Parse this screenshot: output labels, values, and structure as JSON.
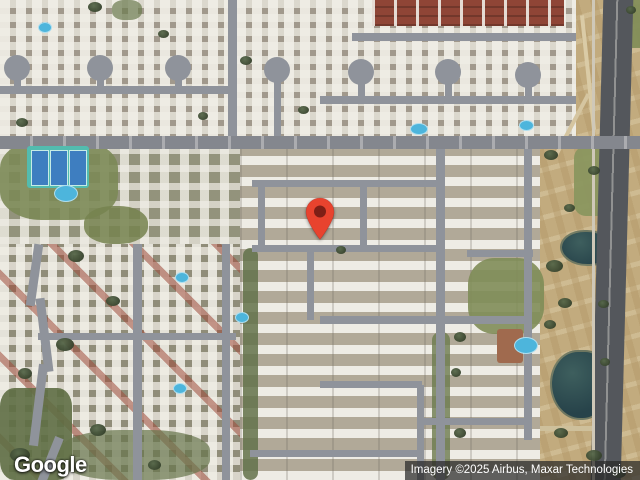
{
  "ui": {
    "logo_text": "Google",
    "attribution_text": "Imagery ©2025 Airbus, Maxar Technologies"
  },
  "map": {
    "type": "satellite",
    "marker": {
      "x": 320,
      "y": 241,
      "color": "#E8432E",
      "dot_color": "#7E1F16"
    },
    "palette": {
      "road": "#8F939B",
      "road_major": "#84878E",
      "highway": "#54575C",
      "desert": "#C2AB7E",
      "pond": "#27434A",
      "pool": "#4DB5DC",
      "tennis": "#53BCAF",
      "court": "#3E7EC0",
      "roof_white": "#F0EEE6",
      "roof_red": "#9E4B3B",
      "grass": "#7C8A57",
      "tree": "#36422C",
      "marker_red": "#E8432E"
    },
    "features": [
      {
        "n": "desert-strip",
        "x": 532,
        "y": 0,
        "w": 108,
        "h": 480,
        "cls": "pattern-desert"
      },
      {
        "n": "district-top-left",
        "x": 0,
        "y": 0,
        "w": 236,
        "h": 148,
        "cls": "pattern-houses"
      },
      {
        "n": "district-top-mid",
        "x": 236,
        "y": 0,
        "w": 340,
        "h": 148,
        "cls": "pattern-houses"
      },
      {
        "n": "district-mid-left",
        "x": 0,
        "y": 148,
        "w": 240,
        "h": 96,
        "cls": "pattern-houses-sparse"
      },
      {
        "n": "district-center-condos",
        "x": 240,
        "y": 148,
        "w": 300,
        "h": 332,
        "cls": "pattern-condos"
      },
      {
        "n": "district-bottom-left",
        "x": 0,
        "y": 244,
        "w": 240,
        "h": 236,
        "cls": "pattern-houses-red"
      },
      {
        "n": "red-roof-apartments",
        "x": 372,
        "y": 0,
        "w": 192,
        "h": 26,
        "cls": "pattern-red-roofs"
      },
      {
        "n": "green-park",
        "x": 0,
        "y": 140,
        "w": 118,
        "h": 80,
        "c": "#7C8A57",
        "r": "35%",
        "o": 0.9
      },
      {
        "n": "green-patch",
        "x": 84,
        "y": 206,
        "w": 64,
        "h": 38,
        "c": "#75834F",
        "r": "45%",
        "o": 0.85
      },
      {
        "n": "green-trees",
        "x": 0,
        "y": 388,
        "w": 72,
        "h": 92,
        "c": "#5E6E44",
        "r": "20%",
        "o": 0.9
      },
      {
        "n": "green-trees",
        "x": 60,
        "y": 430,
        "w": 150,
        "h": 50,
        "c": "#66754B",
        "r": "40%",
        "o": 0.7
      },
      {
        "n": "green-tree-strip",
        "x": 243,
        "y": 248,
        "w": 15,
        "h": 232,
        "c": "#63724A",
        "r": "8px",
        "o": 0.85
      },
      {
        "n": "green-lawn",
        "x": 468,
        "y": 258,
        "w": 76,
        "h": 76,
        "c": "#7F8D58",
        "r": "35%",
        "o": 0.9
      },
      {
        "n": "green-grass",
        "x": 574,
        "y": 146,
        "w": 44,
        "h": 70,
        "c": "#8A965F",
        "r": "12px",
        "o": 0.95
      },
      {
        "n": "green-corner",
        "x": 620,
        "y": 0,
        "w": 20,
        "h": 48,
        "c": "#7F8D58",
        "o": 0.9
      },
      {
        "n": "green-trees",
        "x": 112,
        "y": 0,
        "w": 30,
        "h": 20,
        "c": "#6B7A4E",
        "r": "40%",
        "o": 0.7
      },
      {
        "n": "green-strip",
        "x": 432,
        "y": 332,
        "w": 18,
        "h": 148,
        "c": "#6B7A4E",
        "r": "8px",
        "o": 0.8
      },
      {
        "n": "pond-small",
        "x": 560,
        "y": 230,
        "w": 48,
        "h": 32,
        "cls": "pond",
        "r": "50% 50% 45% 55%"
      },
      {
        "n": "pond-large",
        "x": 550,
        "y": 350,
        "w": 54,
        "h": 66,
        "cls": "pond",
        "r": "55% 45% 50% 60%"
      },
      {
        "n": "desert-path",
        "x": 586,
        "y": 15,
        "w": 4,
        "h": 115,
        "c": "#DACBA6",
        "rot": -6
      },
      {
        "n": "desert-path",
        "x": 570,
        "y": 90,
        "w": 4,
        "h": 70,
        "c": "#D5C5A0",
        "rot": 28
      },
      {
        "n": "desert-path",
        "x": 540,
        "y": 426,
        "w": 72,
        "h": 5,
        "c": "#CEC09B"
      },
      {
        "n": "highway",
        "x": 597,
        "y": -6,
        "w": 30,
        "h": 492,
        "cls": "highway",
        "rot": 1.5
      },
      {
        "n": "highway-shoulder",
        "x": 592,
        "y": 0,
        "w": 3,
        "h": 480,
        "c": "#CFC8B8"
      },
      {
        "n": "road",
        "x": 0,
        "y": 86,
        "w": 236,
        "h": 8,
        "cls": "road"
      },
      {
        "n": "road",
        "x": 352,
        "y": 33,
        "w": 224,
        "h": 8,
        "cls": "road"
      },
      {
        "n": "road",
        "x": 320,
        "y": 96,
        "w": 256,
        "h": 8,
        "cls": "road"
      },
      {
        "n": "road",
        "x": 252,
        "y": 180,
        "w": 192,
        "h": 7,
        "cls": "road"
      },
      {
        "n": "road",
        "x": 252,
        "y": 245,
        "w": 192,
        "h": 7,
        "cls": "road"
      },
      {
        "n": "road",
        "x": 467,
        "y": 250,
        "w": 66,
        "h": 7,
        "cls": "road"
      },
      {
        "n": "road",
        "x": 320,
        "y": 316,
        "w": 208,
        "h": 8,
        "cls": "road"
      },
      {
        "n": "road",
        "x": 38,
        "y": 333,
        "w": 198,
        "h": 7,
        "cls": "road"
      },
      {
        "n": "road",
        "x": 320,
        "y": 381,
        "w": 102,
        "h": 7,
        "cls": "road"
      },
      {
        "n": "road",
        "x": 417,
        "y": 418,
        "w": 110,
        "h": 7,
        "cls": "road"
      },
      {
        "n": "road",
        "x": 250,
        "y": 450,
        "w": 172,
        "h": 7,
        "cls": "road"
      },
      {
        "n": "road",
        "x": 228,
        "y": 0,
        "w": 9,
        "h": 144,
        "cls": "road"
      },
      {
        "n": "road",
        "x": 133,
        "y": 244,
        "w": 9,
        "h": 236,
        "cls": "road"
      },
      {
        "n": "road",
        "x": 222,
        "y": 244,
        "w": 8,
        "h": 236,
        "cls": "road"
      },
      {
        "n": "road",
        "x": 436,
        "y": 148,
        "w": 9,
        "h": 332,
        "cls": "road"
      },
      {
        "n": "road",
        "x": 524,
        "y": 148,
        "w": 8,
        "h": 292,
        "cls": "road"
      },
      {
        "n": "road",
        "x": 258,
        "y": 183,
        "w": 7,
        "h": 66,
        "cls": "road"
      },
      {
        "n": "road",
        "x": 360,
        "y": 183,
        "w": 7,
        "h": 66,
        "cls": "road"
      },
      {
        "n": "road",
        "x": 307,
        "y": 250,
        "w": 7,
        "h": 70,
        "cls": "road"
      },
      {
        "n": "road",
        "x": 417,
        "y": 385,
        "w": 7,
        "h": 95,
        "cls": "road"
      },
      {
        "n": "road-curve",
        "x": 30,
        "y": 244,
        "w": 9,
        "h": 62,
        "cls": "road",
        "rot": 8
      },
      {
        "n": "road-curve",
        "x": 40,
        "y": 298,
        "w": 9,
        "h": 74,
        "cls": "road",
        "rot": -7
      },
      {
        "n": "road-curve",
        "x": 34,
        "y": 364,
        "w": 9,
        "h": 82,
        "cls": "road",
        "rot": 7
      },
      {
        "n": "road-curve",
        "x": 46,
        "y": 436,
        "w": 9,
        "h": 48,
        "cls": "road",
        "rot": 22
      },
      {
        "n": "culdesac-stem",
        "x": 14,
        "y": 74,
        "w": 7,
        "h": 14,
        "cls": "road"
      },
      {
        "n": "culdesac-stem",
        "x": 97,
        "y": 74,
        "w": 7,
        "h": 14,
        "cls": "road"
      },
      {
        "n": "culdesac-stem",
        "x": 175,
        "y": 74,
        "w": 7,
        "h": 14,
        "cls": "road"
      },
      {
        "n": "culdesac-stem",
        "x": 274,
        "y": 80,
        "w": 7,
        "h": 58,
        "cls": "road"
      },
      {
        "n": "culdesac-stem",
        "x": 358,
        "y": 80,
        "w": 7,
        "h": 20,
        "cls": "road"
      },
      {
        "n": "culdesac-stem",
        "x": 445,
        "y": 80,
        "w": 7,
        "h": 20,
        "cls": "road"
      },
      {
        "n": "culdesac-stem",
        "x": 525,
        "y": 82,
        "w": 7,
        "h": 18,
        "cls": "road"
      },
      {
        "n": "culdesac",
        "x": 4,
        "y": 55,
        "w": 26,
        "h": 26,
        "cls": "road",
        "r": "50%"
      },
      {
        "n": "culdesac",
        "x": 87,
        "y": 55,
        "w": 26,
        "h": 26,
        "cls": "road",
        "r": "50%"
      },
      {
        "n": "culdesac",
        "x": 165,
        "y": 55,
        "w": 26,
        "h": 26,
        "cls": "road",
        "r": "50%"
      },
      {
        "n": "culdesac",
        "x": 264,
        "y": 57,
        "w": 26,
        "h": 26,
        "cls": "road",
        "r": "50%"
      },
      {
        "n": "culdesac",
        "x": 348,
        "y": 59,
        "w": 26,
        "h": 26,
        "cls": "road",
        "r": "50%"
      },
      {
        "n": "culdesac",
        "x": 435,
        "y": 59,
        "w": 26,
        "h": 26,
        "cls": "road",
        "r": "50%"
      },
      {
        "n": "culdesac",
        "x": 515,
        "y": 62,
        "w": 26,
        "h": 26,
        "cls": "road",
        "r": "50%"
      },
      {
        "n": "road-main",
        "x": 0,
        "y": 136,
        "w": 640,
        "h": 13,
        "cls": "road-major"
      },
      {
        "n": "clubhouse",
        "x": 497,
        "y": 329,
        "w": 26,
        "h": 34,
        "c": "#A06A4E",
        "r": "3px"
      },
      {
        "n": "tennis-courts",
        "x": 27,
        "y": 146,
        "w": 62,
        "h": 42,
        "c": "#53BCAF",
        "r": "3px"
      },
      {
        "n": "tennis-court",
        "x": 31,
        "y": 150,
        "w": 16,
        "h": 34,
        "cls": "court"
      },
      {
        "n": "tennis-court",
        "x": 50,
        "y": 150,
        "w": 16,
        "h": 34,
        "cls": "court"
      },
      {
        "n": "tennis-court",
        "x": 69,
        "y": 150,
        "w": 16,
        "h": 34,
        "cls": "court"
      },
      {
        "n": "pool",
        "x": 38,
        "y": 22,
        "w": 12,
        "h": 9,
        "cls": "pool"
      },
      {
        "n": "pool",
        "x": 54,
        "y": 185,
        "w": 22,
        "h": 15,
        "cls": "pool"
      },
      {
        "n": "pool",
        "x": 410,
        "y": 123,
        "w": 16,
        "h": 10,
        "cls": "pool"
      },
      {
        "n": "pool",
        "x": 519,
        "y": 120,
        "w": 13,
        "h": 9,
        "cls": "pool"
      },
      {
        "n": "pool",
        "x": 175,
        "y": 272,
        "w": 12,
        "h": 9,
        "cls": "pool"
      },
      {
        "n": "pool",
        "x": 235,
        "y": 312,
        "w": 12,
        "h": 9,
        "cls": "pool"
      },
      {
        "n": "pool",
        "x": 173,
        "y": 383,
        "w": 12,
        "h": 9,
        "cls": "pool"
      },
      {
        "n": "pool",
        "x": 514,
        "y": 337,
        "w": 22,
        "h": 15,
        "cls": "pool"
      },
      {
        "n": "tree",
        "x": 88,
        "y": 2,
        "w": 14,
        "h": 10,
        "cls": "tree"
      },
      {
        "n": "tree",
        "x": 158,
        "y": 30,
        "w": 11,
        "h": 8,
        "cls": "tree"
      },
      {
        "n": "tree",
        "x": 240,
        "y": 56,
        "w": 12,
        "h": 9,
        "cls": "tree"
      },
      {
        "n": "tree",
        "x": 298,
        "y": 106,
        "w": 11,
        "h": 8,
        "cls": "tree"
      },
      {
        "n": "tree",
        "x": 198,
        "y": 112,
        "w": 10,
        "h": 8,
        "cls": "tree"
      },
      {
        "n": "tree",
        "x": 16,
        "y": 118,
        "w": 12,
        "h": 9,
        "cls": "tree"
      },
      {
        "n": "tree",
        "x": 68,
        "y": 250,
        "w": 16,
        "h": 12,
        "cls": "tree"
      },
      {
        "n": "tree",
        "x": 106,
        "y": 296,
        "w": 14,
        "h": 10,
        "cls": "tree"
      },
      {
        "n": "tree",
        "x": 56,
        "y": 338,
        "w": 18,
        "h": 13,
        "cls": "tree"
      },
      {
        "n": "tree",
        "x": 18,
        "y": 368,
        "w": 14,
        "h": 11,
        "cls": "tree"
      },
      {
        "n": "tree",
        "x": 90,
        "y": 424,
        "w": 16,
        "h": 12,
        "cls": "tree"
      },
      {
        "n": "tree",
        "x": 10,
        "y": 448,
        "w": 20,
        "h": 14,
        "cls": "tree"
      },
      {
        "n": "tree",
        "x": 148,
        "y": 460,
        "w": 13,
        "h": 10,
        "cls": "tree"
      },
      {
        "n": "tree",
        "x": 336,
        "y": 246,
        "w": 10,
        "h": 8,
        "cls": "tree"
      },
      {
        "n": "tree",
        "x": 454,
        "y": 332,
        "w": 12,
        "h": 10,
        "cls": "tree"
      },
      {
        "n": "tree",
        "x": 451,
        "y": 368,
        "w": 10,
        "h": 9,
        "cls": "tree"
      },
      {
        "n": "tree",
        "x": 454,
        "y": 428,
        "w": 12,
        "h": 10,
        "cls": "tree"
      },
      {
        "n": "tree",
        "x": 544,
        "y": 150,
        "w": 14,
        "h": 10,
        "cls": "tree"
      },
      {
        "n": "tree",
        "x": 588,
        "y": 166,
        "w": 12,
        "h": 9,
        "cls": "tree"
      },
      {
        "n": "tree",
        "x": 564,
        "y": 204,
        "w": 11,
        "h": 8,
        "cls": "tree"
      },
      {
        "n": "tree",
        "x": 546,
        "y": 260,
        "w": 17,
        "h": 12,
        "cls": "tree"
      },
      {
        "n": "tree",
        "x": 558,
        "y": 298,
        "w": 14,
        "h": 10,
        "cls": "tree"
      },
      {
        "n": "tree",
        "x": 598,
        "y": 300,
        "w": 11,
        "h": 8,
        "cls": "tree"
      },
      {
        "n": "tree",
        "x": 544,
        "y": 320,
        "w": 12,
        "h": 9,
        "cls": "tree"
      },
      {
        "n": "tree",
        "x": 600,
        "y": 358,
        "w": 10,
        "h": 8,
        "cls": "tree"
      },
      {
        "n": "tree",
        "x": 554,
        "y": 428,
        "w": 14,
        "h": 10,
        "cls": "tree"
      },
      {
        "n": "tree",
        "x": 586,
        "y": 450,
        "w": 16,
        "h": 11,
        "cls": "tree"
      },
      {
        "n": "tree",
        "x": 612,
        "y": 468,
        "w": 14,
        "h": 10,
        "cls": "tree"
      },
      {
        "n": "tree",
        "x": 626,
        "y": 6,
        "w": 10,
        "h": 8,
        "cls": "tree"
      }
    ]
  }
}
